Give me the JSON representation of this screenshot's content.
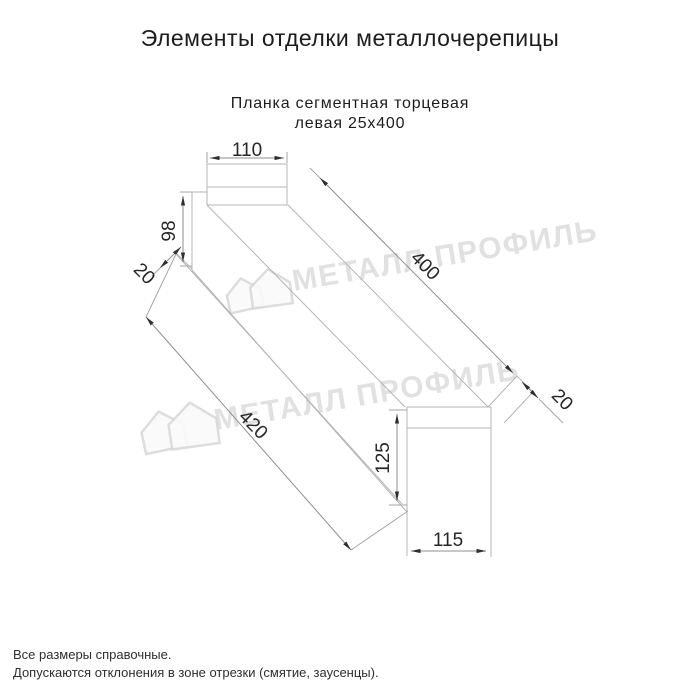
{
  "page": {
    "title": "Элементы отделки металлочерепицы"
  },
  "drawing": {
    "subtitle_line1": "Планка сегментная торцевая",
    "subtitle_line2": "левая 25х400",
    "dimensions": {
      "flange_top_width": "110",
      "near_face_height": "98",
      "near_hem": "20",
      "length_top": "400",
      "length_bottom": "420",
      "far_lip": "20",
      "far_face_height": "125",
      "far_bottom_width": "115"
    }
  },
  "watermark": {
    "brand": "МЕТАЛЛ ПРОФИЛЬ"
  },
  "footer": {
    "note1": "Все размеры справочные.",
    "note2": "Допускаются отклонения в зоне отрезки (смятие, заусенцы)."
  },
  "colors": {
    "background": "#ffffff",
    "part_line": "#b5b5b5",
    "dimension_line": "#8f8f8f",
    "dimension_text": "#262626",
    "watermark": "#d7d7d7"
  }
}
